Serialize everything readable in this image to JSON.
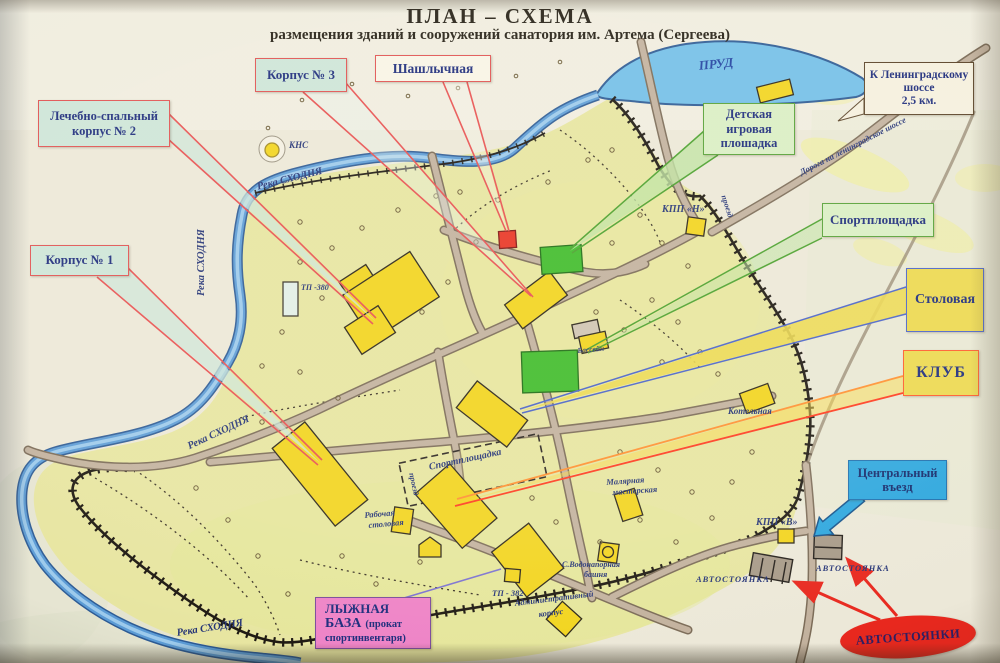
{
  "title": {
    "main": "ПЛАН – СХЕМА",
    "sub": "размещения зданий и сооружений санатория им. Артема (Сергеева)"
  },
  "callouts": {
    "korpus3": {
      "label": "Корпус № 3"
    },
    "shashlychnaya": {
      "label": "Шашлычная"
    },
    "korpus2": {
      "line1": "Лечебно-спальный",
      "line2": "корпус № 2"
    },
    "korpus1": {
      "label": "Корпус № 1"
    },
    "detskaya": {
      "line1": "Детская",
      "line2": "игровая",
      "line3": "плошадка"
    },
    "sport": {
      "label": "Спортплощадка"
    },
    "stolovaya": {
      "label": "Столовая"
    },
    "klub": {
      "label": "КЛУБ"
    },
    "vezd": {
      "line1": "Центральный",
      "line2": "въезд"
    },
    "shosse": {
      "line1": "К Ленинградскому",
      "line2": "шоссе",
      "line3": "2,5 км."
    },
    "lyzhnaya": {
      "line1": "ЛЫЖНАЯ",
      "line2": "БАЗА",
      "line2b": "(прокат",
      "line3": "спортинвентаря)"
    },
    "avtostoyanki": {
      "label": "АВТОСТОЯНКИ"
    }
  },
  "map_labels": {
    "prud": "ПРУД",
    "reka_top": "Река СХОДНЯ",
    "reka_left": "Река СХОДНЯ",
    "reka_sw": "Река СХОДНЯ",
    "reka_bottom": "Река СХОДНЯ",
    "doroga": "Дорога на ленинградское шоссе",
    "kns": "КНС",
    "tp380": "ТП -380",
    "kpp_n": "КПП «Н»",
    "kpp_v": "КПП «В»",
    "kotelnaya": "Котельная",
    "bassein": "Бассейн",
    "sport_field": "Спортплощадка",
    "malyarnaya1": "Малярная",
    "malyarnaya2": "мастерская",
    "rab1": "Рабочая",
    "rab2": "столовая",
    "bashnya1": "С.Водонапорная",
    "bashnya2": "башня",
    "tp382": "ТП - 382",
    "admin1": "Административный",
    "admin2": "корпус",
    "avtostoyanka_left": "АВТОСТОЯНКА",
    "avtostoyanka_right": "АВТОСТОЯНКА",
    "proezd": "проезд"
  },
  "colors": {
    "water": "#5b9bd5",
    "terrain": "#e7e5a0",
    "building_yellow": "#f2d41c",
    "playground_green": "#3fbb2a",
    "shashlychnaya_red": "#e93323",
    "road": "#c2b19d",
    "callout_red_border": "#e05050",
    "callout_green_border": "#55a035",
    "entry_blue": "#2ba6de",
    "parking_oval_red": "#e8281e",
    "label_navy": "#1b2a7b"
  }
}
